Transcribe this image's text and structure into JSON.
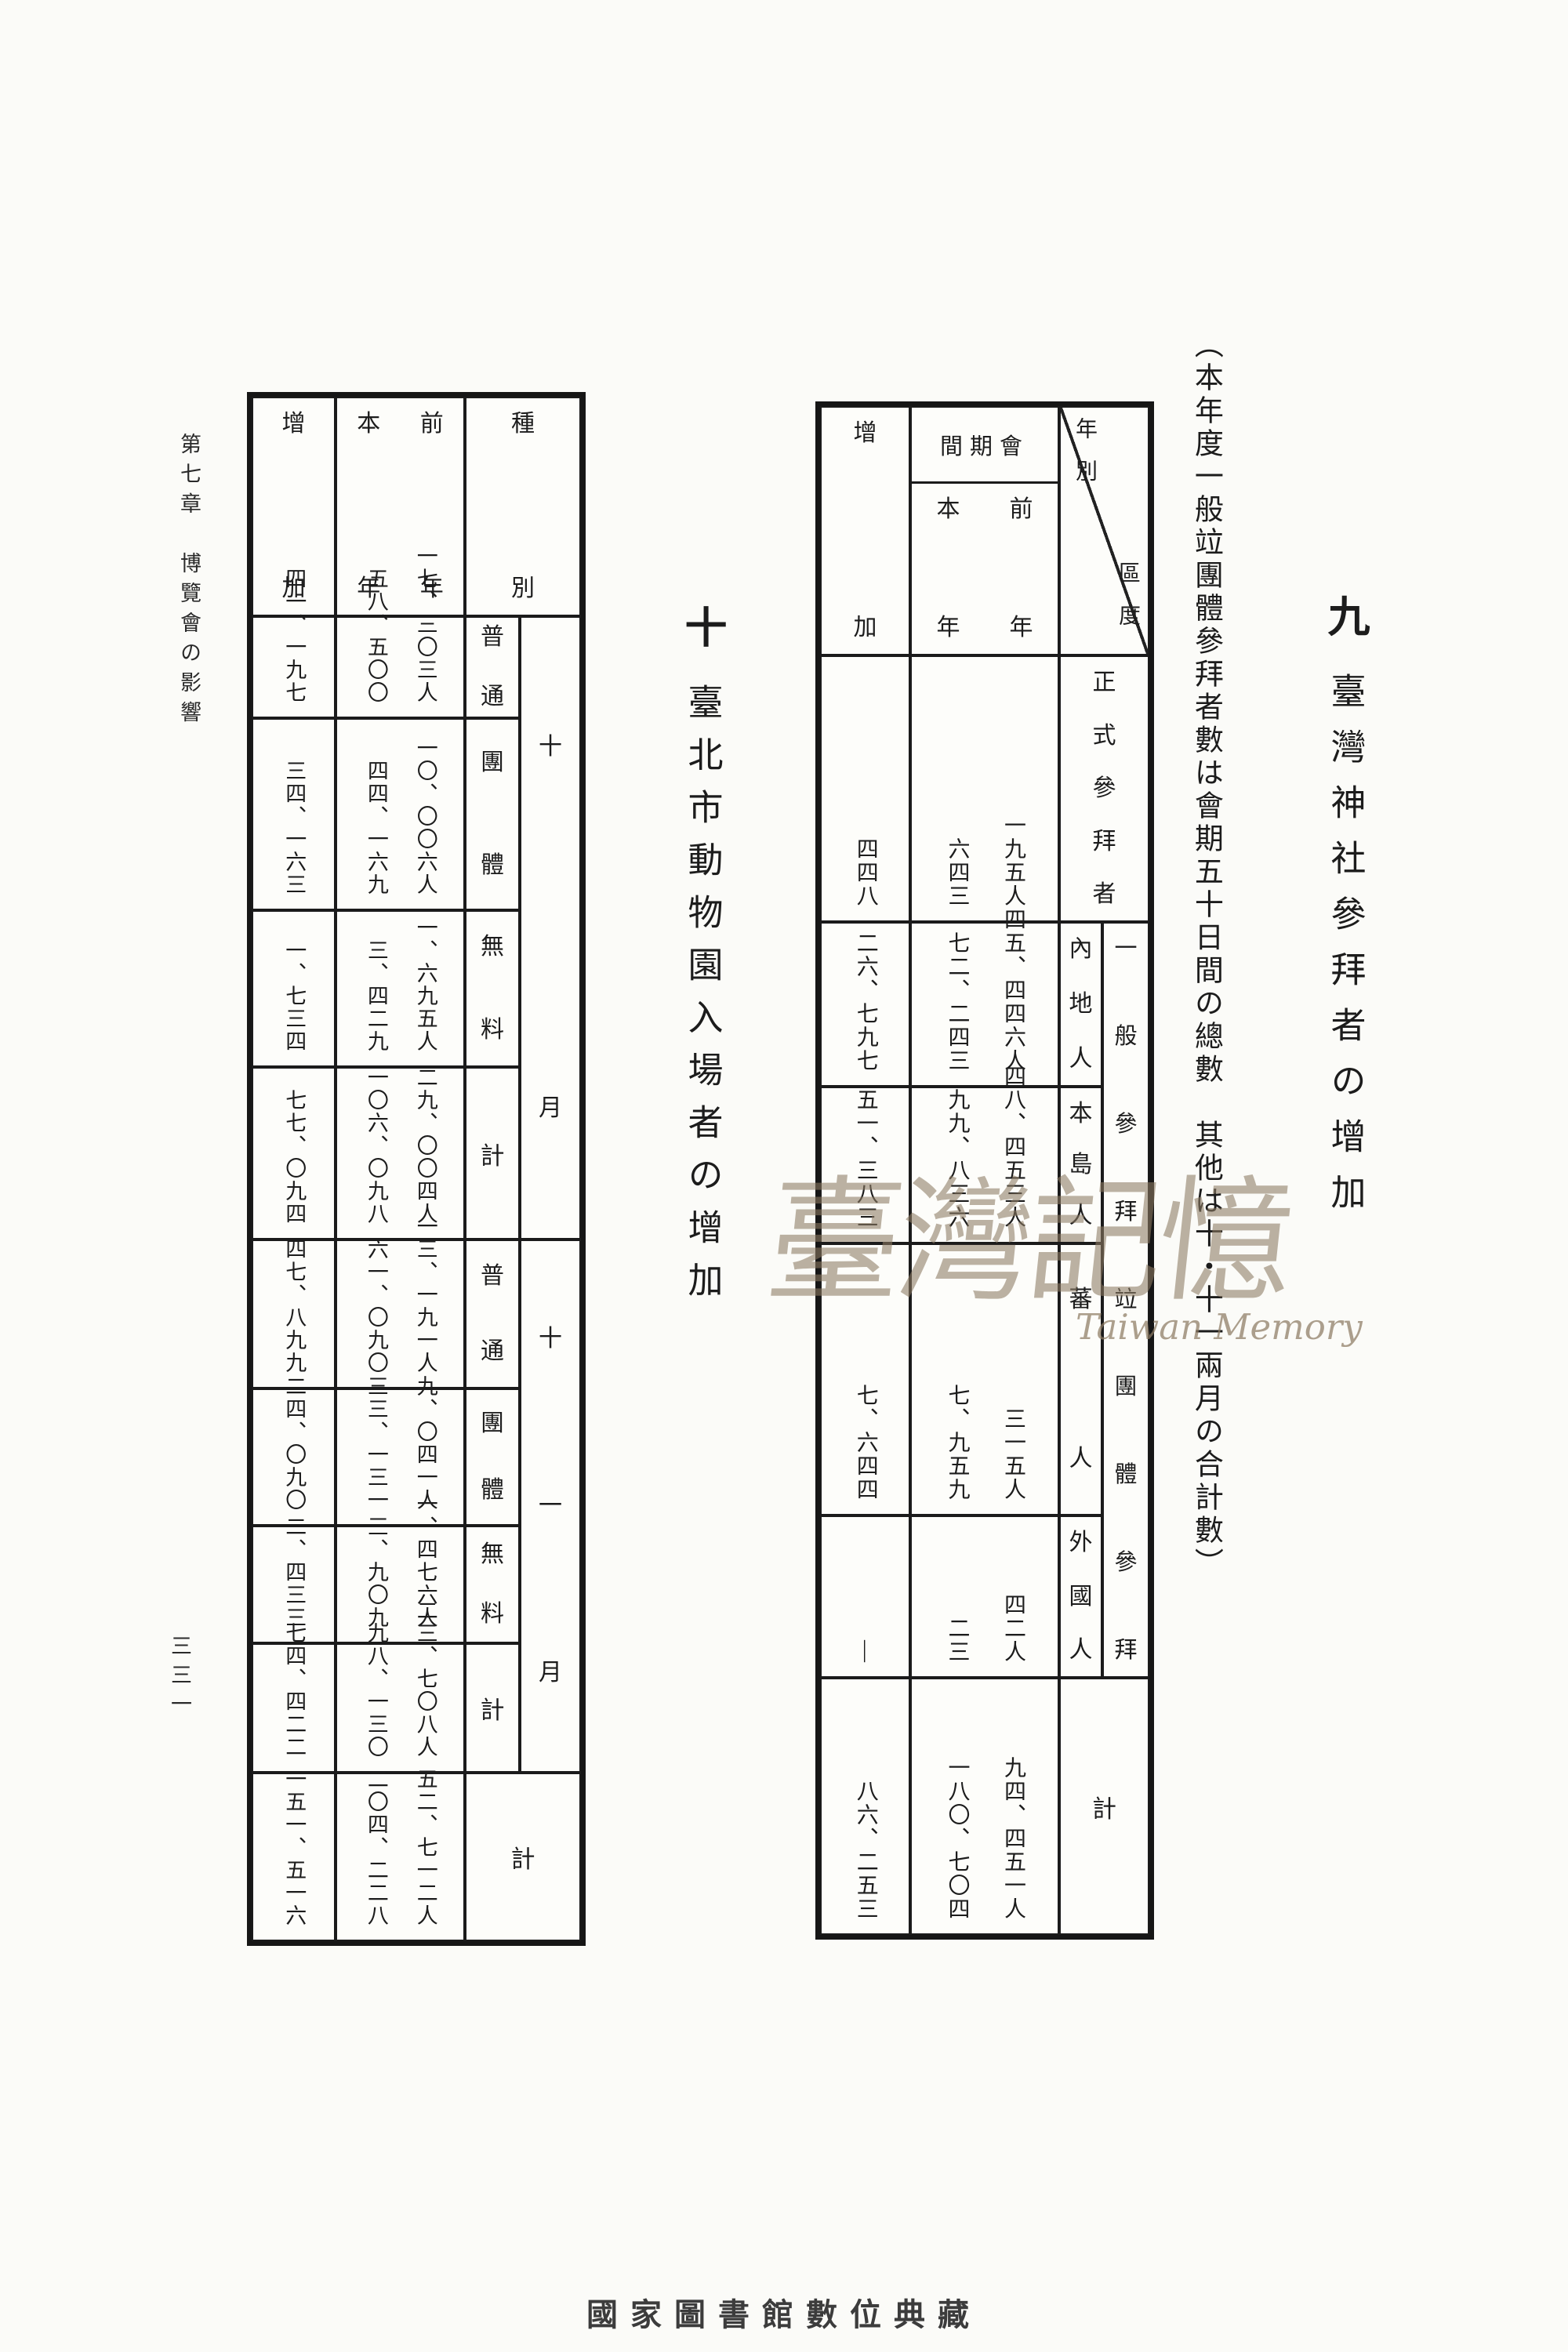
{
  "page": {
    "margin_header": "第七章　博覽會の影響",
    "page_number": "三三一",
    "footer": "國家圖書館數位典藏",
    "watermark": {
      "cjk": "臺灣記憶",
      "latin": "Taiwan Memory"
    }
  },
  "section9": {
    "number": "九",
    "title": "臺灣神社參拜者の增加",
    "note": "（本年度一般竝團體參拜者數は會期五十日間の總數　其他は十・十一兩月の合計數）"
  },
  "section10": {
    "number": "十",
    "title": "臺北市動物園入場者の增加"
  },
  "shrine_table": {
    "corner": {
      "upper": "年別",
      "lower": "區度"
    },
    "header": {
      "inc": "增加",
      "session": "間期會",
      "curr": "本年",
      "prev": "前年"
    },
    "general_label": "一般參拜竝團體參拜",
    "rows": [
      {
        "label": "正式參拜者",
        "prev": "一九五人",
        "curr": "六四三",
        "inc": "四四八"
      },
      {
        "label": "內地人",
        "prev": "四五、四四六人",
        "curr": "七二、二四三",
        "inc": "二六、七九七"
      },
      {
        "label": "本島人",
        "prev": "四八、四五三人",
        "curr": "九九、八三六",
        "inc": "五一、三八三"
      },
      {
        "label": "蕃人",
        "prev": "三一五人",
        "curr": "七、九五九",
        "inc": "七、六四四"
      },
      {
        "label": "外國人",
        "prev": "四二人",
        "curr": "二三",
        "inc": "—"
      },
      {
        "label": "計",
        "prev": "九四、四五一人",
        "curr": "一八〇、七〇四",
        "inc": "八六、二五三"
      }
    ]
  },
  "zoo_table": {
    "corner": "種別",
    "header": {
      "inc": "增加",
      "curr": "本年",
      "prev": "前年"
    },
    "groups": {
      "oct": "十月",
      "nov": "十一月"
    },
    "rows": [
      {
        "cat": "普通",
        "prev": "一七、三〇三人",
        "curr": "五八、五〇〇",
        "inc": "四一、一九七"
      },
      {
        "cat": "團體",
        "prev": "一〇、〇〇六人",
        "curr": "四四、一六九",
        "inc": "三四、一六三"
      },
      {
        "cat": "無料",
        "prev": "一、六九五人",
        "curr": "三、四二九",
        "inc": "一、七三四"
      },
      {
        "cat": "計",
        "prev": "二九、〇〇四人",
        "curr": "一〇六、〇九八",
        "inc": "七七、〇九四"
      },
      {
        "cat": "普通",
        "prev": "一三、一九一人",
        "curr": "六一、〇九〇",
        "inc": "四七、八九九"
      },
      {
        "cat": "團體",
        "prev": "九、〇四一人",
        "curr": "三三、一三一",
        "inc": "二四、〇九〇"
      },
      {
        "cat": "無料",
        "prev": "一、四七六人",
        "curr": "三、九〇九",
        "inc": "二、四三三"
      },
      {
        "cat": "計",
        "prev": "二三、七〇八人",
        "curr": "九八、一三〇",
        "inc": "七四、四二二"
      },
      {
        "cat": "計",
        "prev": "五二、七一二人",
        "curr": "二〇四、二二八",
        "inc": "一五一、五一六"
      }
    ]
  }
}
